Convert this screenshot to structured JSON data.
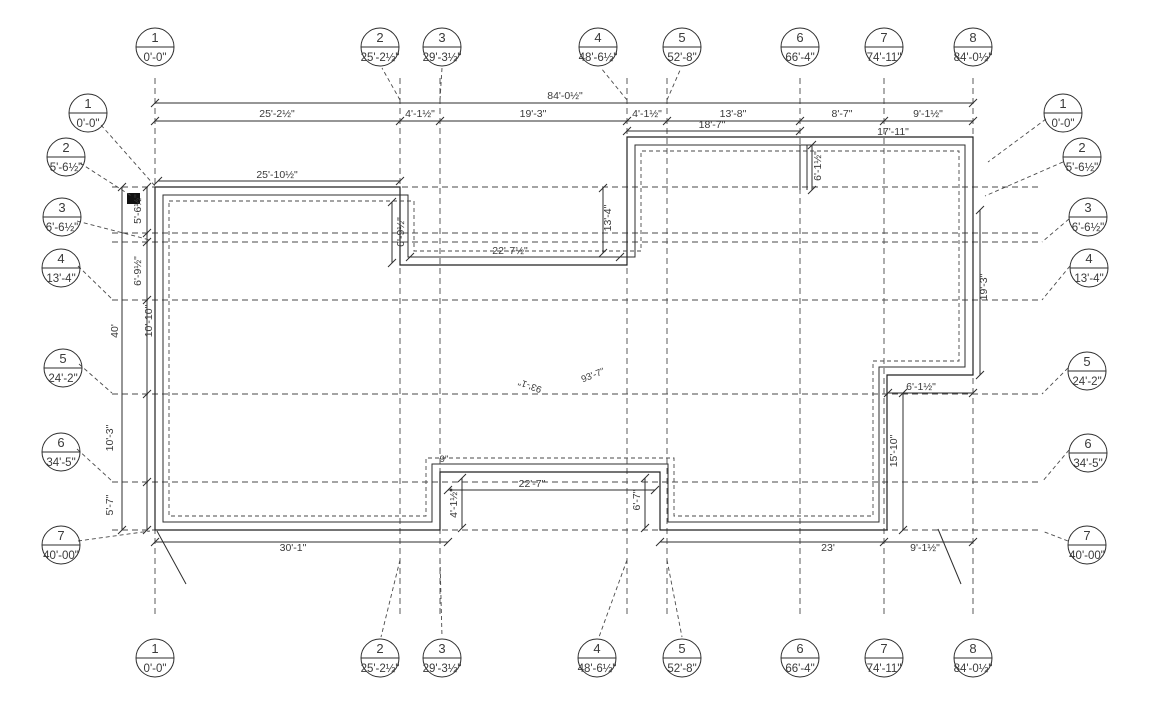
{
  "bubbles": {
    "cols": [
      {
        "n": "1",
        "v": "0'-0\""
      },
      {
        "n": "2",
        "v": "25'-2½\""
      },
      {
        "n": "3",
        "v": "29'-3½\""
      },
      {
        "n": "4",
        "v": "48'-6½\""
      },
      {
        "n": "5",
        "v": "52'-8\""
      },
      {
        "n": "6",
        "v": "66'-4\""
      },
      {
        "n": "7",
        "v": "74'-11\""
      },
      {
        "n": "8",
        "v": "84'-0½\""
      }
    ],
    "rows": [
      {
        "n": "1",
        "v": "0'-0\""
      },
      {
        "n": "2",
        "v": "5'-6½\""
      },
      {
        "n": "3",
        "v": "6'-6½\""
      },
      {
        "n": "4",
        "v": "13'-4\""
      },
      {
        "n": "5",
        "v": "24'-2\""
      },
      {
        "n": "6",
        "v": "34'-5\""
      },
      {
        "n": "7",
        "v": "40'-00\""
      }
    ]
  },
  "dims": {
    "overall_width": "84'-0½\"",
    "overall_height": "40'",
    "top_chain": [
      "25'-2½\"",
      "4'-1½\"",
      "19'-3\"",
      "4'-1½\"",
      "13'-8\"",
      "8'-7\"",
      "9'-1½\""
    ],
    "left_chain": [
      "5'-6½\"",
      "6'-9½\"",
      "10'-10\"",
      "10'-3\"",
      "5'-7\""
    ],
    "bottom_chain": [
      "30'-1\"",
      "23'",
      "9'-1½\""
    ],
    "interior": {
      "top_left_width": "25'-10½\"",
      "left_notch_depth": "6'-9½\"",
      "mid_notch_width": "22'-7½\"",
      "mid_notch_depth": "13'-4\"",
      "upper_right_width_a": "18'-7\"",
      "upper_right_width_b": "17'-11\"",
      "upper_step": "6'-1½\"",
      "right_side_height": "19'-3\"",
      "right_step_width": "6'-1½\"",
      "right_lower_height": "15'-10\"",
      "bottom_notch_width": "22'-7\"",
      "bottom_notch_left": "4'-1½\"",
      "bottom_notch_right": "6'-7\"",
      "bottom_notch_offset": "9\"",
      "diag_a": "93'-1\"",
      "diag_b": "93'-7\""
    }
  }
}
